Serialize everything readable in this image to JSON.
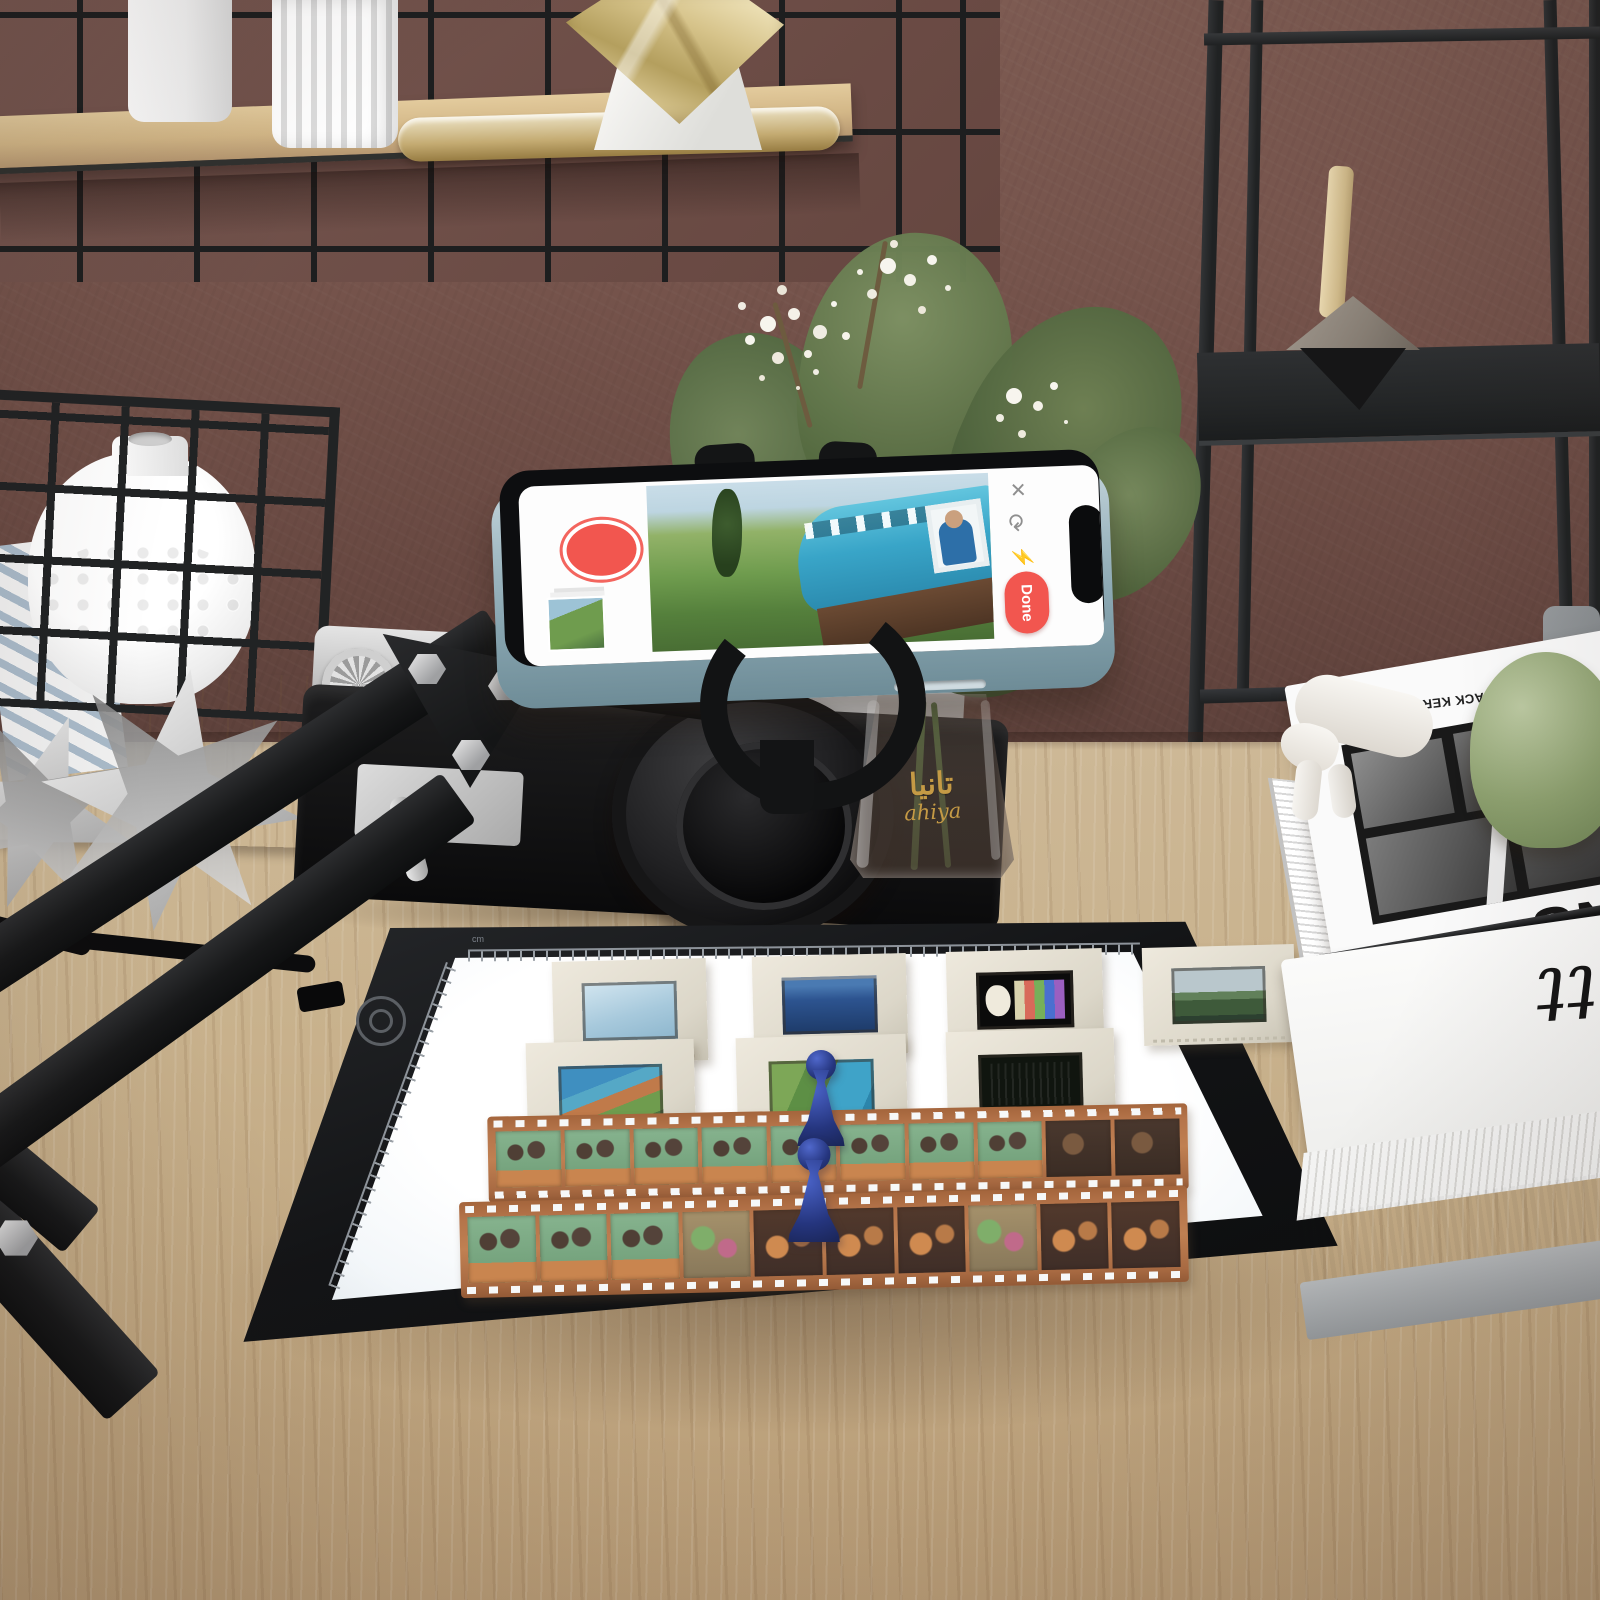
{
  "scene": {
    "setting": "desk with phone film-scanning rig on LED light pad"
  },
  "phone": {
    "done_button": "Done",
    "icons": {
      "close": "✕",
      "auto_capture": "⟳",
      "flash": "⚡"
    }
  },
  "light_pad": {
    "ruler_unit": "cm",
    "slide_count": 7,
    "film_strip_count": 2,
    "magnet_pawn_count": 2
  },
  "vase": {
    "arabic_text": "تانيا",
    "latin_text": "ahiya"
  },
  "books": {
    "caption": "introduction by JACK KEROUAC",
    "title_fragment": "ANS",
    "lower_title_fragment": "itt"
  },
  "colors": {
    "accent_red": "#F2564F",
    "pawn_blue": "#27387F",
    "film_base": "#B97A4E",
    "wall": "#6F4F48",
    "desk_wood": "#C7AE89",
    "pad_surface": "#F7FAFC",
    "gold_text": "#C59A45"
  }
}
